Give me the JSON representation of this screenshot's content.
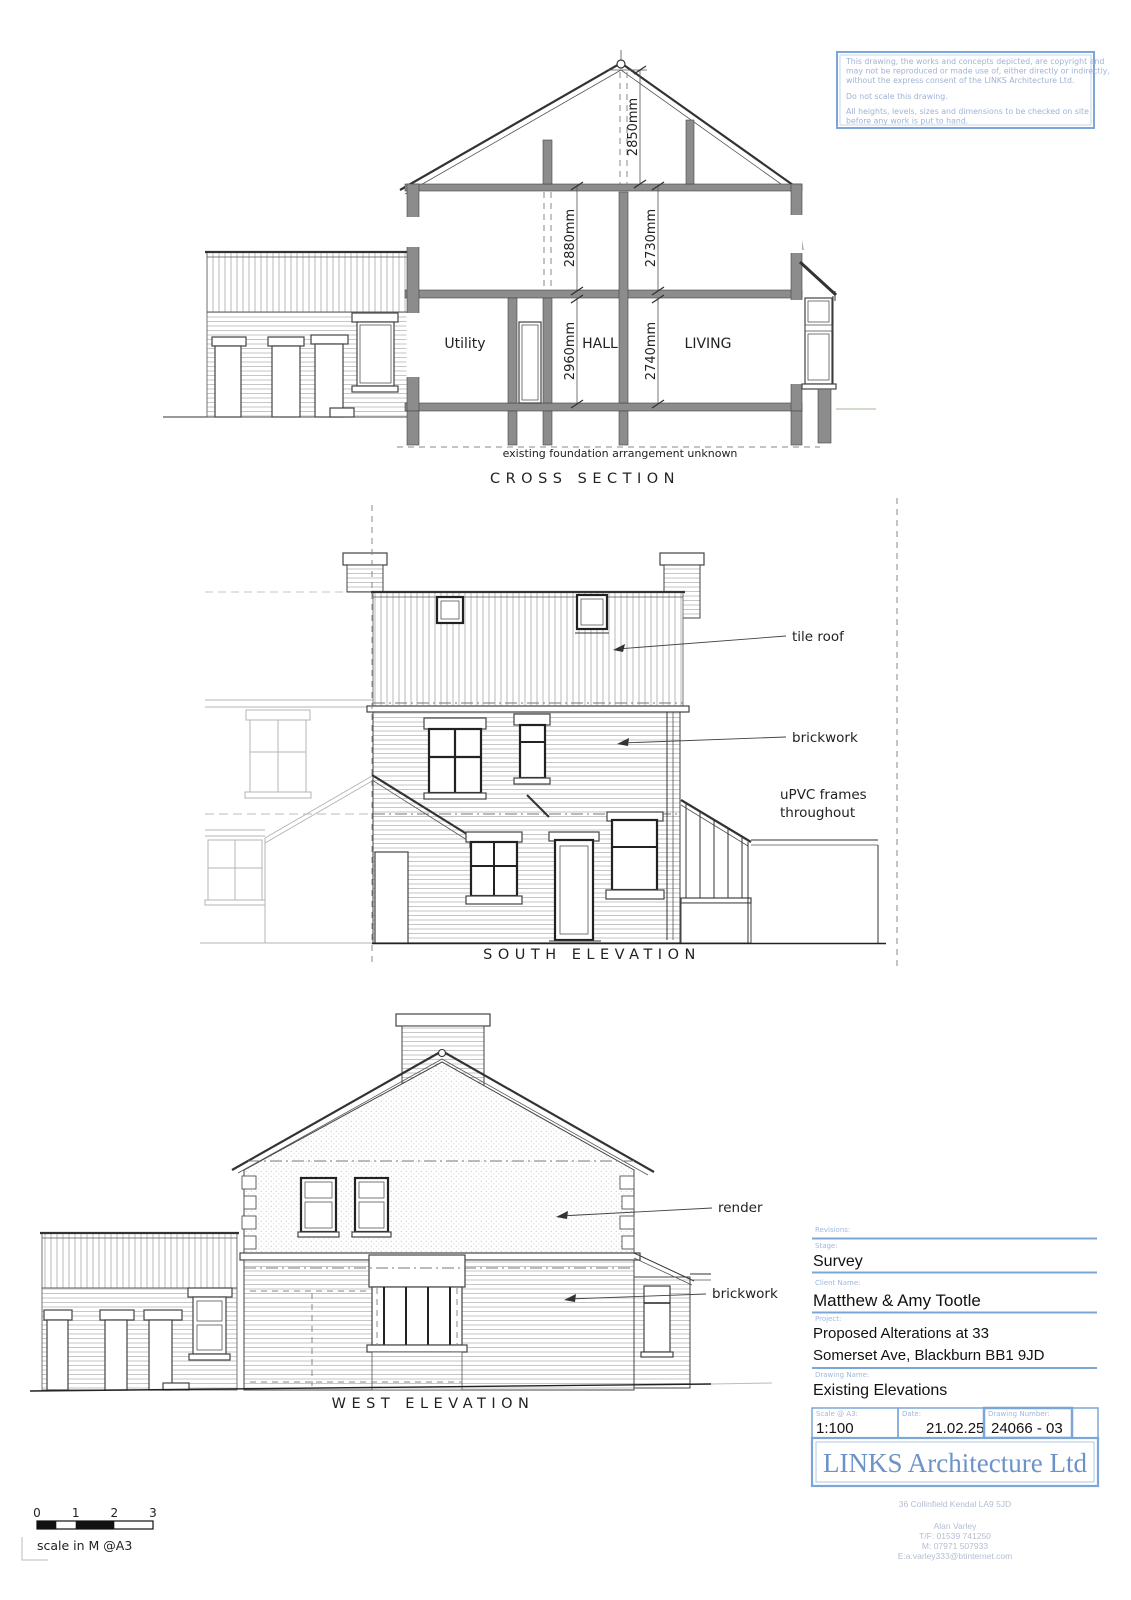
{
  "colors": {
    "accent_blue": "#7ca6d8",
    "label_blue": "#9db8dd",
    "company_blue": "#6b93c8",
    "drawing_line": "#333333"
  },
  "copyright": {
    "lines": [
      "This drawing, the works and concepts depicted, are copyright and",
      "may not be reproduced or made use of, either directly or indirectly,",
      "without the express consent of the LINKS Architecture Ltd.",
      "Do not scale this drawing.",
      "All heights, levels, sizes and dimensions to be checked on site",
      "before any work is put to hand."
    ]
  },
  "cross_section": {
    "title": "CROSS SECTION",
    "rooms": {
      "utility": "Utility",
      "hall": "HALL",
      "living": "LIVING"
    },
    "dims": {
      "ridge": "2850mm",
      "first_left": "2880mm",
      "first_right": "2730mm",
      "ground_left": "2960mm",
      "ground_right": "2740mm"
    },
    "foundation_note": "existing foundation arrangement unknown"
  },
  "south_elevation": {
    "title": "SOUTH ELEVATION",
    "labels": {
      "tile_roof": "tile roof",
      "brickwork": "brickwork",
      "upvc_line1": "uPVC frames",
      "upvc_line2": "throughout"
    }
  },
  "west_elevation": {
    "title": "WEST ELEVATION",
    "labels": {
      "render": "render",
      "brickwork": "brickwork"
    }
  },
  "scale_bar": {
    "ticks": [
      "0",
      "1",
      "2",
      "3"
    ],
    "caption": "scale in M @A3"
  },
  "title_block": {
    "revisions_label": "Revisions:",
    "stage_label": "Stage:",
    "stage": "Survey",
    "client_label": "Client Name:",
    "client": "Matthew & Amy Tootle",
    "project_label": "Project:",
    "project_line1": "Proposed Alterations at 33",
    "project_line2": "Somerset Ave, Blackburn BB1 9JD",
    "drawing_name_label": "Drawing Name:",
    "drawing_name": "Existing Elevations",
    "scale_label": "Scale @ A3:",
    "scale": "1:100",
    "date_label": "Date:",
    "date": "21.02.25",
    "number_label": "Drawing Number:",
    "number": "24066 - 03",
    "company": "LINKS Architecture Ltd",
    "address": "36 Collinfield Kendal LA9 5JD",
    "contact_name": "Alan Varley",
    "phone": "T/F: 01539 741250",
    "mobile": "M: 07971 507933",
    "email": "E:a.varley333@btinternet.com"
  }
}
